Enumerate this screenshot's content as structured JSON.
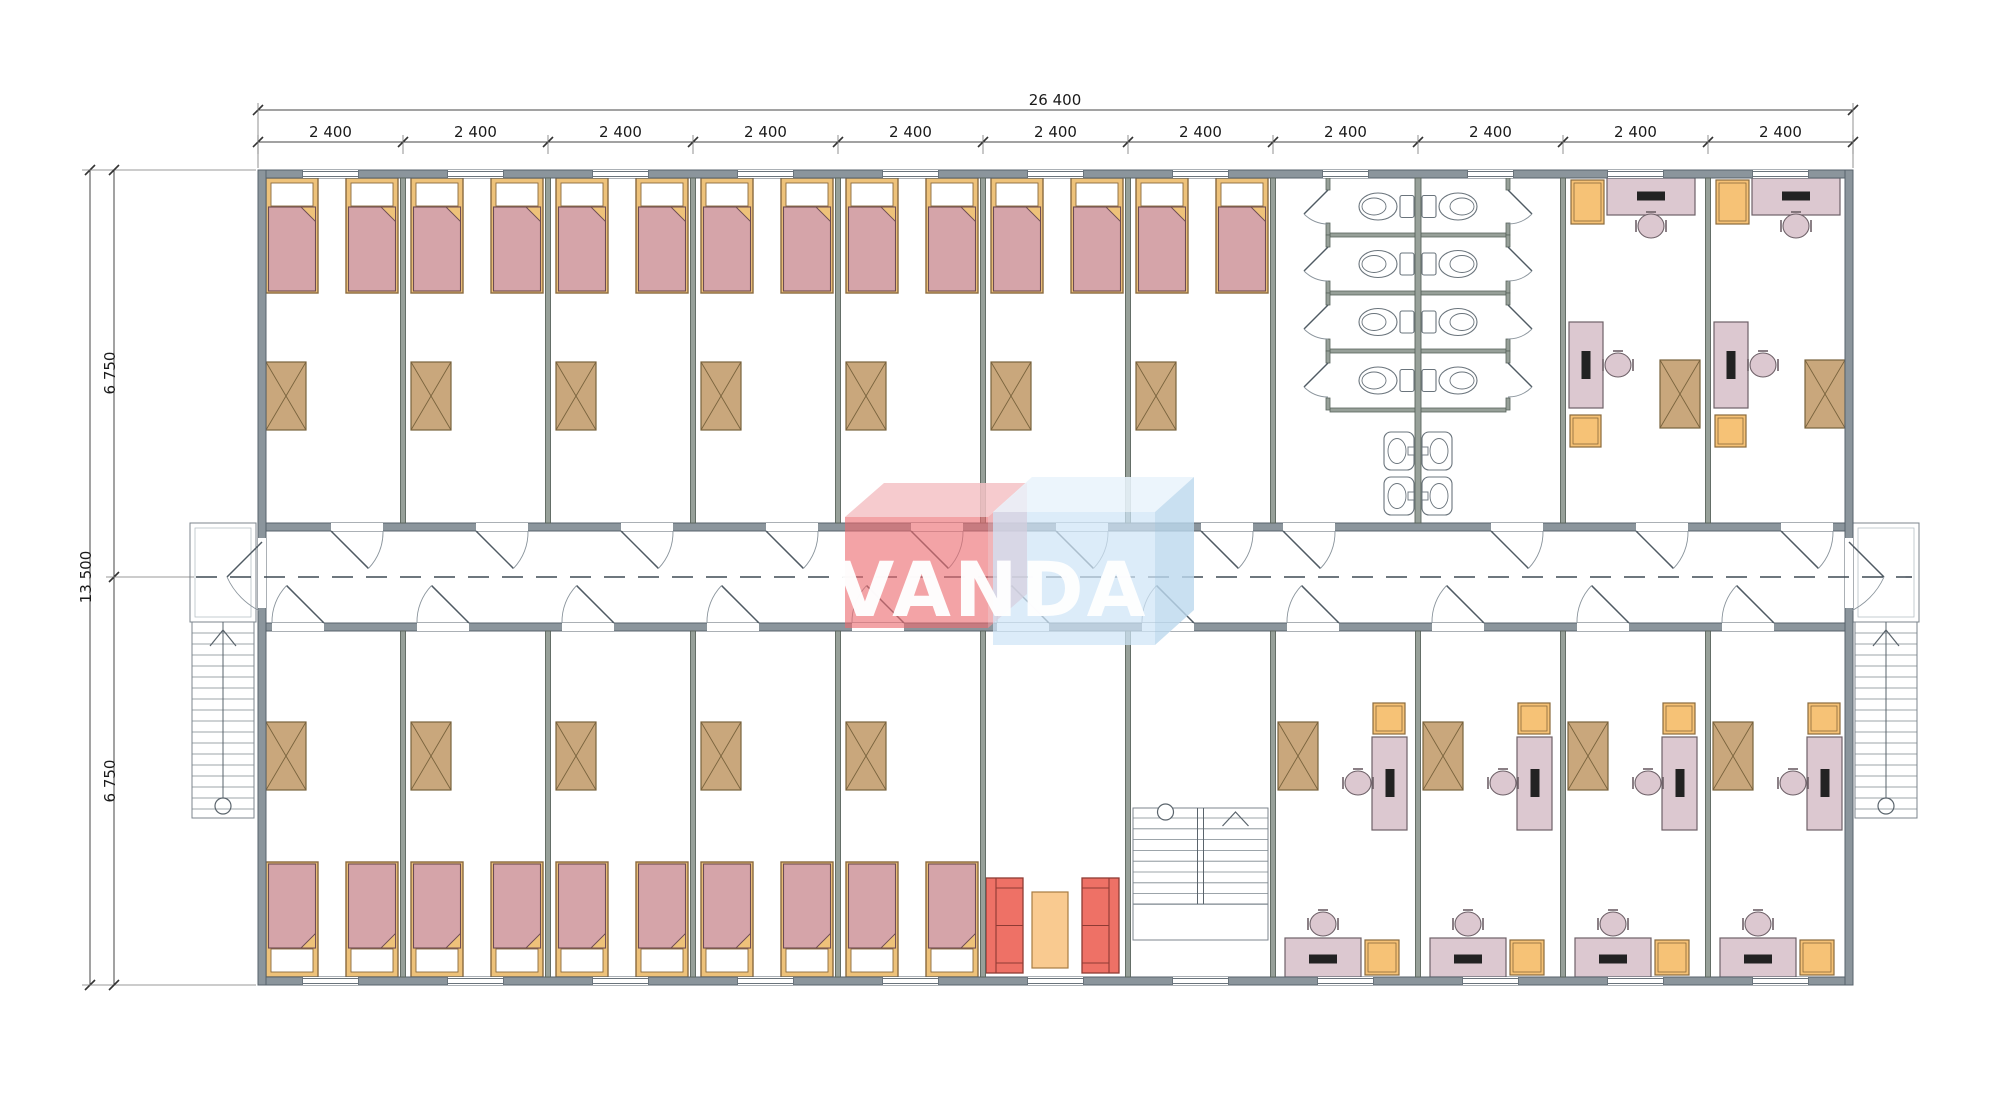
{
  "canvas": {
    "width": 2000,
    "height": 1099,
    "background": "#ffffff"
  },
  "watermark": {
    "text": "VANDA",
    "red_front": "#ec6a70",
    "red_top": "#f5c2c5",
    "red_side": "#e9959b",
    "blue_front": "#cfe4f6",
    "blue_top": "#e9f4fc",
    "blue_side": "#bcd8ee",
    "text_color": "#ffffff"
  },
  "dimensions": {
    "top_total": {
      "label": "26 400"
    },
    "top_module": {
      "label": "2 400",
      "count": 11
    },
    "left_total": {
      "label": "13 500"
    },
    "left_half": {
      "label": "6 750",
      "count": 2
    }
  },
  "plan": {
    "top_wing": {
      "bedrooms": 7,
      "beds_per_bedroom": 2,
      "wardrobes_per_bedroom": 1,
      "wc_stalls": 8,
      "wc_sinks": 4,
      "offices": 2
    },
    "bottom_wing": {
      "bedrooms": 5,
      "beds_per_bedroom": 2,
      "wardrobes_per_bedroom": 1,
      "lounge": {
        "sofas": 2,
        "coffee_tables": 1
      },
      "internal_stairs": 1,
      "offices": 4
    },
    "external_stairs": 2
  },
  "colors": {
    "wall": "#8b959c",
    "wall_stroke": "#57626b",
    "partition": "#97a099",
    "partition_stroke": "#59645c",
    "bed_frame": "#eec27a",
    "bed_frame_stroke": "#8a6a3e",
    "blanket": "#d5a4a9",
    "blanket_stroke": "#6d4c52",
    "wardrobe": "#c9a77c",
    "wardrobe_stroke": "#79633d",
    "desk": "#dcc8d0",
    "desk_stroke": "#6e6168",
    "cabinet": "#f6c276",
    "cabinet_stroke": "#8a6a3c",
    "sofa": "#ee7166",
    "sofa_stroke": "#8e3b34",
    "table": "#f9ca90",
    "table_stroke": "#a87c42",
    "fixture_stroke": "#6a747c",
    "stair_stroke": "#7c868e",
    "stair_inner": "#b8c0c6",
    "door": "#4f5a63",
    "door_arc": "#8a949c",
    "centerline": "#3f4a54",
    "dim_line": "#444444",
    "dim_ext": "#777777",
    "dim_tick": "#333333"
  }
}
